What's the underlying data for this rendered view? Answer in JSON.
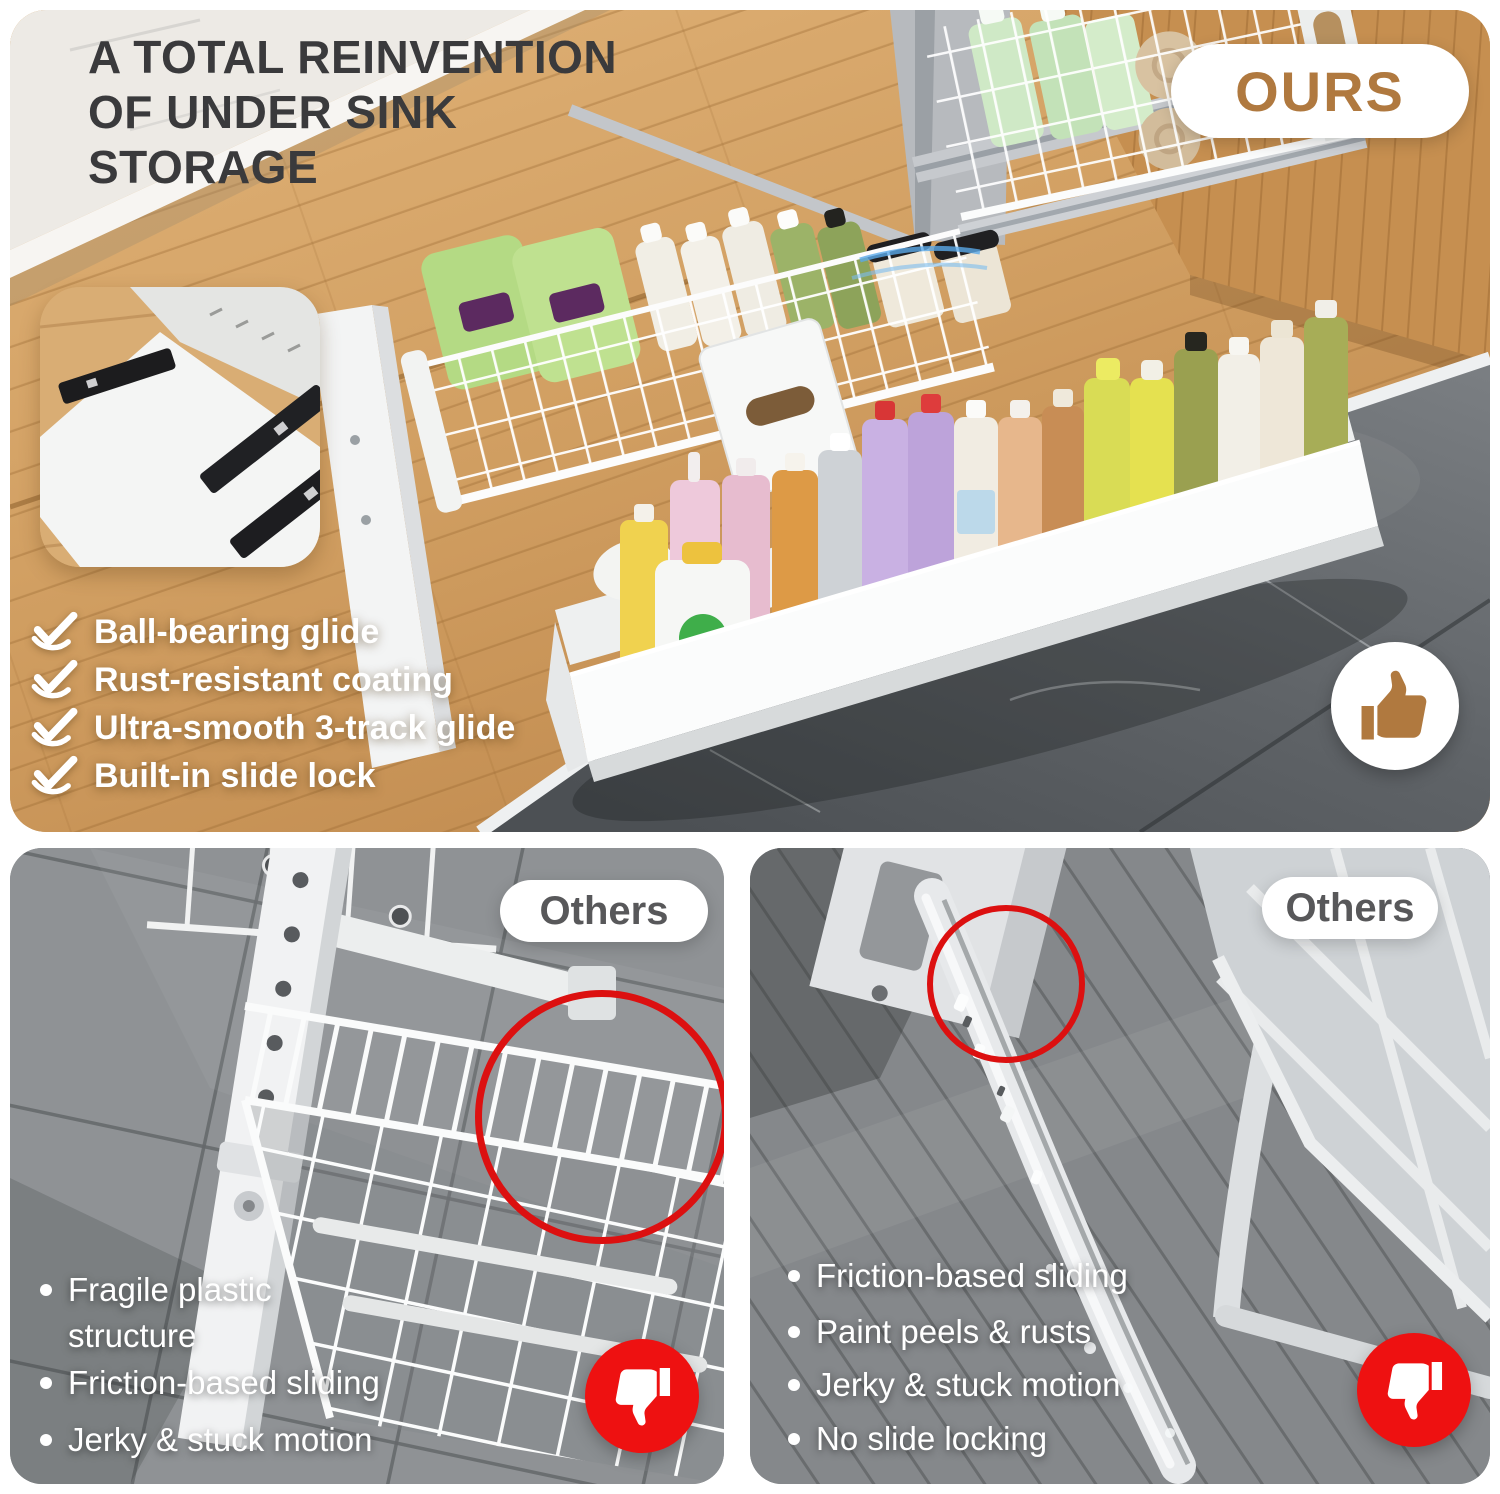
{
  "header": {
    "title_lines": [
      "A TOTAL REINVENTION",
      "OF UNDER SINK",
      "STORAGE"
    ],
    "badge_label": "OURS"
  },
  "features": {
    "items": [
      "Ball-bearing glide",
      "Rust-resistant coating",
      "Ultra-smooth 3-track glide",
      "Built-in slide lock"
    ]
  },
  "comparison_left": {
    "badge_label": "Others",
    "bullets": [
      "Fragile plastic structure",
      "Friction-based sliding",
      "Jerky & stuck motion"
    ]
  },
  "comparison_right": {
    "badge_label": "Others",
    "bullets": [
      "Friction-based sliding",
      "Paint peels & rusts",
      "Jerky & stuck motion",
      "No slide locking"
    ]
  },
  "icons": {
    "ours_verdict": "thumbs-up-icon",
    "others_verdict": "thumbs-down-icon",
    "feature_marker": "check-icon",
    "defect_marker": "red-circle-annotation"
  },
  "colors": {
    "accent_brown": "#b0793f",
    "alert_red": "#ee1111",
    "annotation_red": "#dc1010",
    "title_gray": "#3a3a3c",
    "others_text_gray": "#58585a",
    "feature_text": "#ffffff"
  }
}
